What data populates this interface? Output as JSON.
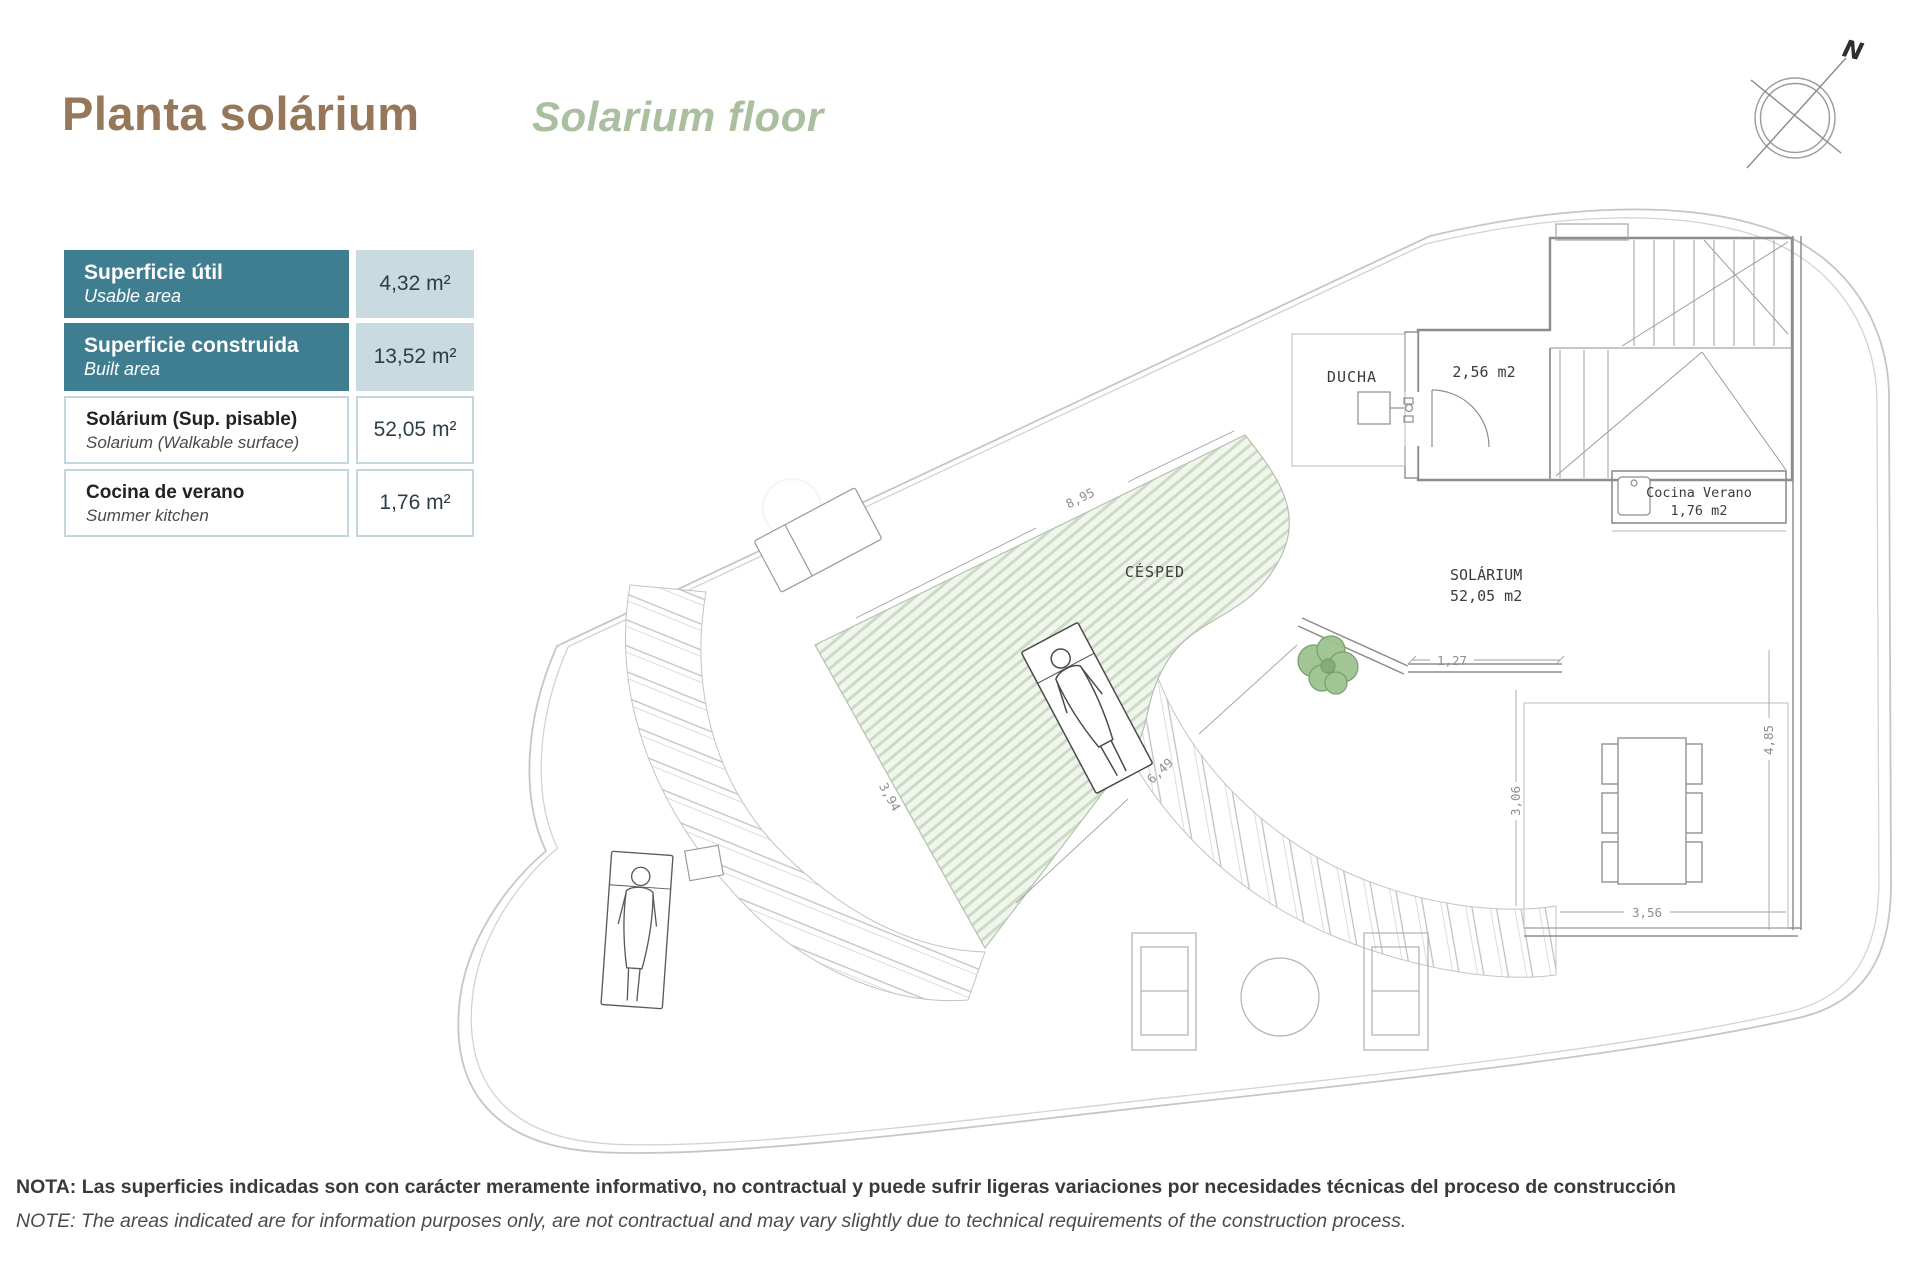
{
  "header": {
    "title": "Planta solárium",
    "subtitle": "Solarium floor"
  },
  "compass": {
    "north": "N"
  },
  "areas_table": {
    "rows": [
      {
        "label_es": "Superficie útil",
        "label_en": "Usable area",
        "value": "4,32 m²"
      },
      {
        "label_es": "Superficie construida",
        "label_en": "Built area",
        "value": "13,52 m²"
      },
      {
        "label_es": "Solárium (Sup. pisable)",
        "label_en": "Solarium (Walkable surface)",
        "value": "52,05 m²"
      },
      {
        "label_es": "Cocina de verano",
        "label_en": "Summer kitchen",
        "value": "1,76 m²"
      }
    ]
  },
  "plan": {
    "labels": {
      "ducha": "DUCHA",
      "room_area": "2,56 m2",
      "cocina_1": "Cocina Verano",
      "cocina_2": "1,76 m2",
      "solarium_1": "SOLÁRIUM",
      "solarium_2": "52,05 m2",
      "cesped": "CÉSPED"
    },
    "dimensions": {
      "grass_top": "8,95",
      "grass_left": "3,94",
      "grass_bottom": "6,49",
      "terrace_top": "1,27",
      "terrace_mid": "3,06",
      "terrace_right": "4,85",
      "terrace_bottom": "3,56"
    }
  },
  "footer": {
    "note_es": "NOTA: Las superficies indicadas son con carácter meramente informativo, no contractual y puede sufrir ligeras variaciones por necesidades técnicas del proceso de construcción",
    "note_en": "NOTE: The areas indicated are for information purposes only, are not contractual and may vary slightly due to technical requirements of the construction process."
  },
  "colors": {
    "accent_teal": "#3f7e91",
    "value_cell_blue": "#c9dae0",
    "title_brown": "#97775a",
    "subtitle_green": "#a9bfa0",
    "grass_hatch_green": "#cadcc3"
  }
}
